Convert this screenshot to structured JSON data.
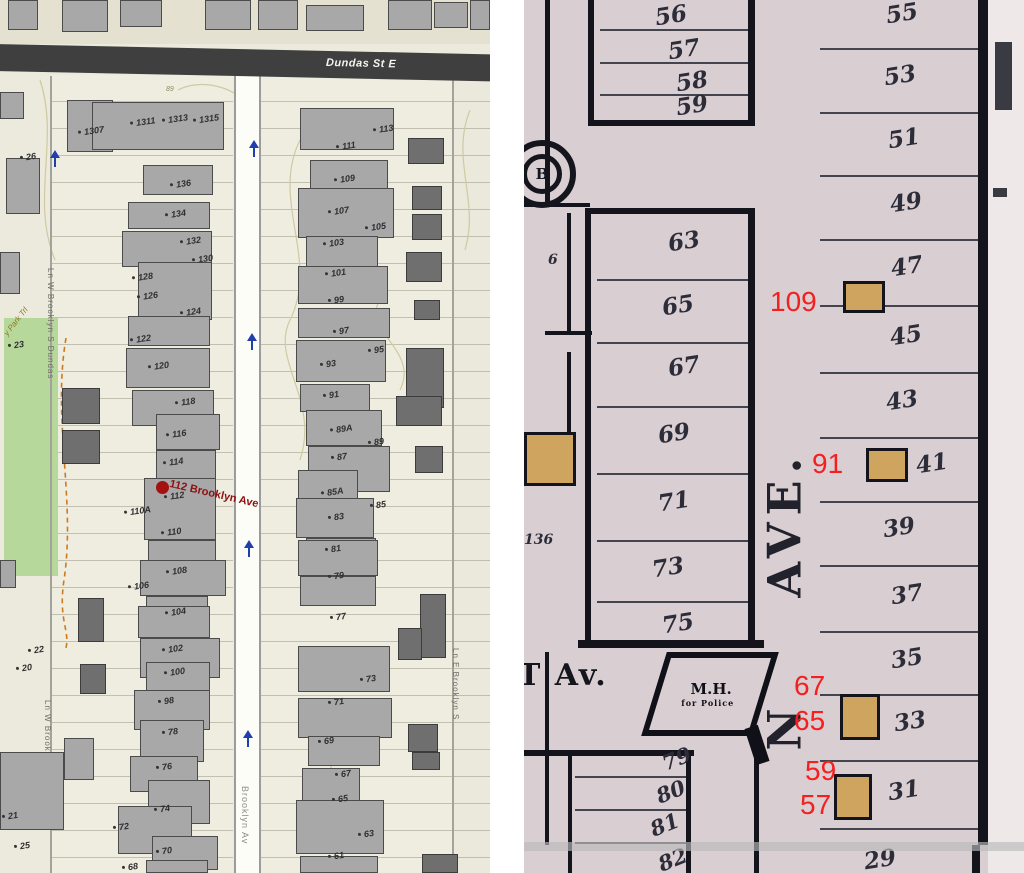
{
  "colors": {
    "red_annotation": "#f42020",
    "selected_red": "#8c1111",
    "park_green": "#b7d89b",
    "road_band_dark": "#3f3f3f",
    "building_gray": "#a8a8a8",
    "building_dark": "#6f6f6f",
    "atlas_tan": "#cfa45f",
    "atlas_pink": "#d9ced2",
    "arrow_blue": "#1f3fae"
  },
  "left_map": {
    "streets": {
      "dundas": "Dundas St E",
      "brooklyn_road": "Brooklyn Av",
      "lane_w1": "Ln W Brooklyn S Dundas",
      "lane_w2": "Ln W Brooklyn S Dundas",
      "lane_e": "Ln E Brooklyn S",
      "park_trail": "y Park Trl"
    },
    "selected": {
      "label": "112 Brooklyn Ave"
    },
    "contour_label": "89",
    "house_labels": [
      {
        "t": "1307",
        "x": 78,
        "y": 126
      },
      {
        "t": "1311",
        "x": 130,
        "y": 117
      },
      {
        "t": "1313",
        "x": 162,
        "y": 114
      },
      {
        "t": "1315",
        "x": 193,
        "y": 114
      },
      {
        "t": "136",
        "x": 170,
        "y": 179
      },
      {
        "t": "134",
        "x": 165,
        "y": 209
      },
      {
        "t": "132",
        "x": 180,
        "y": 236
      },
      {
        "t": "130",
        "x": 192,
        "y": 254
      },
      {
        "t": "128",
        "x": 132,
        "y": 272
      },
      {
        "t": "126",
        "x": 137,
        "y": 291
      },
      {
        "t": "124",
        "x": 180,
        "y": 307
      },
      {
        "t": "122",
        "x": 130,
        "y": 334
      },
      {
        "t": "120",
        "x": 148,
        "y": 361
      },
      {
        "t": "118",
        "x": 175,
        "y": 397
      },
      {
        "t": "116",
        "x": 166,
        "y": 429
      },
      {
        "t": "114",
        "x": 163,
        "y": 457
      },
      {
        "t": "112",
        "x": 164,
        "y": 491
      },
      {
        "t": "110A",
        "x": 124,
        "y": 506
      },
      {
        "t": "110",
        "x": 161,
        "y": 527
      },
      {
        "t": "108",
        "x": 166,
        "y": 566
      },
      {
        "t": "106",
        "x": 128,
        "y": 581
      },
      {
        "t": "104",
        "x": 165,
        "y": 607
      },
      {
        "t": "102",
        "x": 162,
        "y": 644
      },
      {
        "t": "100",
        "x": 164,
        "y": 667
      },
      {
        "t": "98",
        "x": 158,
        "y": 696
      },
      {
        "t": "78",
        "x": 162,
        "y": 727
      },
      {
        "t": "76",
        "x": 156,
        "y": 762
      },
      {
        "t": "74",
        "x": 154,
        "y": 804
      },
      {
        "t": "72",
        "x": 113,
        "y": 822
      },
      {
        "t": "70",
        "x": 156,
        "y": 846
      },
      {
        "t": "68",
        "x": 122,
        "y": 862
      },
      {
        "t": "113",
        "x": 373,
        "y": 124
      },
      {
        "t": "111",
        "x": 336,
        "y": 141
      },
      {
        "t": "109",
        "x": 334,
        "y": 174
      },
      {
        "t": "107",
        "x": 328,
        "y": 206
      },
      {
        "t": "105",
        "x": 365,
        "y": 222
      },
      {
        "t": "103",
        "x": 323,
        "y": 238
      },
      {
        "t": "101",
        "x": 325,
        "y": 268
      },
      {
        "t": "99",
        "x": 328,
        "y": 295
      },
      {
        "t": "97",
        "x": 333,
        "y": 326
      },
      {
        "t": "95",
        "x": 368,
        "y": 345
      },
      {
        "t": "93",
        "x": 320,
        "y": 359
      },
      {
        "t": "91",
        "x": 323,
        "y": 390
      },
      {
        "t": "89A",
        "x": 330,
        "y": 424
      },
      {
        "t": "89",
        "x": 368,
        "y": 437
      },
      {
        "t": "87",
        "x": 331,
        "y": 452
      },
      {
        "t": "85A",
        "x": 321,
        "y": 487
      },
      {
        "t": "85",
        "x": 370,
        "y": 500
      },
      {
        "t": "83",
        "x": 328,
        "y": 512
      },
      {
        "t": "81",
        "x": 325,
        "y": 544
      },
      {
        "t": "79",
        "x": 328,
        "y": 571
      },
      {
        "t": "77",
        "x": 330,
        "y": 612
      },
      {
        "t": "73",
        "x": 360,
        "y": 674
      },
      {
        "t": "71",
        "x": 328,
        "y": 697
      },
      {
        "t": "69",
        "x": 318,
        "y": 736
      },
      {
        "t": "67",
        "x": 335,
        "y": 769
      },
      {
        "t": "65",
        "x": 332,
        "y": 794
      },
      {
        "t": "63",
        "x": 358,
        "y": 829
      },
      {
        "t": "61",
        "x": 328,
        "y": 851
      },
      {
        "t": "26",
        "x": 20,
        "y": 152
      },
      {
        "t": "23",
        "x": 8,
        "y": 340
      },
      {
        "t": "22",
        "x": 28,
        "y": 645
      },
      {
        "t": "20",
        "x": 16,
        "y": 663
      },
      {
        "t": "21",
        "x": 2,
        "y": 811
      },
      {
        "t": "25",
        "x": 14,
        "y": 841
      }
    ],
    "buildings": [
      [
        8,
        0,
        30,
        30,
        "g"
      ],
      [
        62,
        0,
        46,
        32,
        "g"
      ],
      [
        120,
        0,
        42,
        27,
        "g"
      ],
      [
        205,
        0,
        46,
        30,
        "g"
      ],
      [
        258,
        0,
        40,
        30,
        "g"
      ],
      [
        306,
        5,
        58,
        26,
        "g"
      ],
      [
        388,
        0,
        44,
        30,
        "g"
      ],
      [
        434,
        2,
        34,
        26,
        "g"
      ],
      [
        470,
        0,
        20,
        30,
        "g"
      ],
      [
        67,
        100,
        46,
        52,
        "g"
      ],
      [
        92,
        102,
        132,
        48,
        "g"
      ],
      [
        143,
        165,
        70,
        30,
        "g"
      ],
      [
        128,
        202,
        82,
        27,
        "g"
      ],
      [
        122,
        231,
        90,
        36,
        "g"
      ],
      [
        138,
        262,
        74,
        58,
        "g"
      ],
      [
        128,
        316,
        82,
        30,
        "g"
      ],
      [
        126,
        348,
        84,
        40,
        "g"
      ],
      [
        132,
        390,
        82,
        36,
        "g"
      ],
      [
        156,
        414,
        64,
        36,
        "g"
      ],
      [
        156,
        450,
        60,
        32,
        "g"
      ],
      [
        144,
        478,
        72,
        62,
        "g"
      ],
      [
        148,
        540,
        68,
        26,
        "g"
      ],
      [
        140,
        560,
        86,
        36,
        "g"
      ],
      [
        146,
        596,
        62,
        28,
        "g"
      ],
      [
        138,
        606,
        72,
        32,
        "g"
      ],
      [
        140,
        638,
        80,
        40,
        "g"
      ],
      [
        146,
        662,
        64,
        30,
        "g"
      ],
      [
        134,
        690,
        76,
        40,
        "g"
      ],
      [
        140,
        720,
        64,
        42,
        "g"
      ],
      [
        130,
        756,
        68,
        36,
        "g"
      ],
      [
        148,
        780,
        62,
        44,
        "g"
      ],
      [
        118,
        806,
        74,
        48,
        "g"
      ],
      [
        152,
        836,
        66,
        34,
        "g"
      ],
      [
        146,
        860,
        62,
        13,
        "g"
      ],
      [
        300,
        108,
        94,
        42,
        "g"
      ],
      [
        310,
        160,
        78,
        30,
        "g"
      ],
      [
        298,
        188,
        96,
        50,
        "g"
      ],
      [
        306,
        236,
        72,
        32,
        "g"
      ],
      [
        298,
        266,
        90,
        38,
        "g"
      ],
      [
        298,
        308,
        92,
        30,
        "g"
      ],
      [
        296,
        340,
        90,
        42,
        "g"
      ],
      [
        300,
        384,
        70,
        28,
        "g"
      ],
      [
        306,
        410,
        76,
        36,
        "g"
      ],
      [
        308,
        446,
        82,
        46,
        "g"
      ],
      [
        298,
        470,
        60,
        30,
        "g"
      ],
      [
        296,
        498,
        78,
        40,
        "g"
      ],
      [
        306,
        538,
        70,
        32,
        "g"
      ],
      [
        298,
        540,
        80,
        36,
        "g"
      ],
      [
        300,
        576,
        76,
        30,
        "g"
      ],
      [
        298,
        646,
        92,
        46,
        "g"
      ],
      [
        298,
        698,
        94,
        40,
        "g"
      ],
      [
        308,
        736,
        72,
        30,
        "g"
      ],
      [
        302,
        768,
        58,
        36,
        "g"
      ],
      [
        296,
        800,
        88,
        54,
        "g"
      ],
      [
        300,
        856,
        78,
        17,
        "g"
      ],
      [
        6,
        158,
        34,
        56,
        "g"
      ],
      [
        0,
        92,
        24,
        27,
        "g"
      ],
      [
        0,
        252,
        20,
        42,
        "g"
      ],
      [
        0,
        560,
        16,
        28,
        "g"
      ],
      [
        0,
        752,
        64,
        78,
        "g"
      ],
      [
        64,
        738,
        30,
        42,
        "g"
      ],
      [
        62,
        388,
        38,
        36,
        "d"
      ],
      [
        62,
        430,
        38,
        34,
        "d"
      ],
      [
        78,
        598,
        26,
        44,
        "d"
      ],
      [
        80,
        664,
        26,
        30,
        "d"
      ],
      [
        408,
        138,
        36,
        26,
        "d"
      ],
      [
        412,
        186,
        30,
        24,
        "d"
      ],
      [
        412,
        214,
        30,
        26,
        "d"
      ],
      [
        406,
        252,
        36,
        30,
        "d"
      ],
      [
        414,
        300,
        26,
        20,
        "d"
      ],
      [
        406,
        348,
        38,
        60,
        "d"
      ],
      [
        396,
        396,
        46,
        30,
        "d"
      ],
      [
        415,
        446,
        28,
        27,
        "d"
      ],
      [
        420,
        594,
        26,
        64,
        "d"
      ],
      [
        398,
        628,
        24,
        32,
        "d"
      ],
      [
        408,
        724,
        30,
        28,
        "d"
      ],
      [
        412,
        752,
        28,
        18,
        "d"
      ],
      [
        422,
        854,
        36,
        19,
        "d"
      ]
    ],
    "arrows": [
      [
        249,
        140
      ],
      [
        247,
        333
      ],
      [
        244,
        540
      ],
      [
        243,
        730
      ],
      [
        50,
        150
      ]
    ]
  },
  "right_map": {
    "street_vertical_word": "AVE.",
    "street_vertical_fragment": "N",
    "cross_street": "T Av.",
    "corner_building": {
      "line1": "M.H.",
      "line2": "for Police"
    },
    "circle_letter": "B",
    "edge_labels": [
      {
        "t": "6",
        "x": 24,
        "y": 252
      },
      {
        "t": "136",
        "x": 0,
        "y": 532
      }
    ],
    "lots_left_top": [
      {
        "t": "56",
        "x": 131,
        "y": 2
      },
      {
        "t": "57",
        "x": 144,
        "y": 36
      },
      {
        "t": "58",
        "x": 152,
        "y": 68
      },
      {
        "t": "59",
        "x": 152,
        "y": 92
      }
    ],
    "lots_left": [
      {
        "t": "63",
        "x": 144,
        "y": 228
      },
      {
        "t": "65",
        "x": 138,
        "y": 292
      },
      {
        "t": "67",
        "x": 144,
        "y": 353
      },
      {
        "t": "69",
        "x": 134,
        "y": 420
      },
      {
        "t": "71",
        "x": 134,
        "y": 488
      },
      {
        "t": "73",
        "x": 128,
        "y": 554
      },
      {
        "t": "75",
        "x": 138,
        "y": 610
      }
    ],
    "lots_bottom": [
      {
        "t": "79",
        "x": 138,
        "y": 746
      },
      {
        "t": "80",
        "x": 132,
        "y": 779
      },
      {
        "t": "81",
        "x": 126,
        "y": 812
      },
      {
        "t": "82",
        "x": 134,
        "y": 847
      }
    ],
    "lots_right": [
      {
        "t": "55",
        "x": 362,
        "y": 0
      },
      {
        "t": "53",
        "x": 360,
        "y": 62
      },
      {
        "t": "51",
        "x": 364,
        "y": 125
      },
      {
        "t": "49",
        "x": 366,
        "y": 189
      },
      {
        "t": "47",
        "x": 367,
        "y": 253
      },
      {
        "t": "45",
        "x": 366,
        "y": 322
      },
      {
        "t": "43",
        "x": 362,
        "y": 387
      },
      {
        "t": "41",
        "x": 392,
        "y": 450
      },
      {
        "t": "39",
        "x": 359,
        "y": 514
      },
      {
        "t": "37",
        "x": 367,
        "y": 581
      },
      {
        "t": "35",
        "x": 367,
        "y": 645
      },
      {
        "t": "33",
        "x": 370,
        "y": 708
      },
      {
        "t": "31",
        "x": 364,
        "y": 777
      },
      {
        "t": "29",
        "x": 340,
        "y": 846
      }
    ],
    "red_annotations": [
      {
        "t": "109",
        "x": 246,
        "y": 286
      },
      {
        "t": "91",
        "x": 288,
        "y": 448
      },
      {
        "t": "67",
        "x": 270,
        "y": 670
      },
      {
        "t": "65",
        "x": 270,
        "y": 705
      },
      {
        "t": "59",
        "x": 281,
        "y": 755
      },
      {
        "t": "57",
        "x": 276,
        "y": 789
      }
    ],
    "tan_icons": [
      [
        319,
        281,
        42,
        32
      ],
      [
        342,
        448,
        42,
        34
      ],
      [
        316,
        694,
        40,
        46
      ],
      [
        310,
        774,
        38,
        46
      ],
      [
        0,
        432,
        52,
        54
      ]
    ],
    "thin_lines": [
      [
        76,
        29,
        150,
        2
      ],
      [
        76,
        62,
        150,
        2
      ],
      [
        76,
        94,
        150,
        2
      ],
      [
        73,
        279,
        151,
        2
      ],
      [
        73,
        342,
        151,
        2
      ],
      [
        73,
        406,
        151,
        2
      ],
      [
        73,
        473,
        151,
        2
      ],
      [
        73,
        540,
        151,
        2
      ],
      [
        73,
        601,
        151,
        2
      ],
      [
        296,
        48,
        158,
        2
      ],
      [
        296,
        112,
        158,
        2
      ],
      [
        296,
        175,
        158,
        2
      ],
      [
        296,
        239,
        158,
        2
      ],
      [
        296,
        305,
        158,
        2
      ],
      [
        296,
        372,
        158,
        2
      ],
      [
        296,
        437,
        158,
        2
      ],
      [
        296,
        501,
        158,
        2
      ],
      [
        296,
        565,
        158,
        2
      ],
      [
        296,
        631,
        158,
        2
      ],
      [
        296,
        694,
        158,
        2
      ],
      [
        296,
        760,
        158,
        2
      ],
      [
        296,
        828,
        158,
        2
      ],
      [
        51,
        776,
        111,
        2
      ],
      [
        51,
        809,
        111,
        2
      ],
      [
        51,
        842,
        111,
        2
      ]
    ],
    "thick_lines": [
      [
        64,
        0,
        6,
        126
      ],
      [
        224,
        0,
        7,
        126
      ],
      [
        64,
        120,
        167,
        6
      ],
      [
        61,
        208,
        170,
        6
      ],
      [
        61,
        208,
        6,
        440
      ],
      [
        224,
        208,
        7,
        436
      ],
      [
        54,
        640,
        186,
        8
      ],
      [
        21,
        0,
        5,
        206
      ],
      [
        0,
        203,
        66,
        4
      ],
      [
        43,
        213,
        4,
        122
      ],
      [
        21,
        331,
        47,
        4
      ],
      [
        43,
        352,
        4,
        80
      ],
      [
        21,
        652,
        4,
        193
      ],
      [
        44,
        755,
        4,
        118
      ],
      [
        162,
        755,
        5,
        118
      ],
      [
        0,
        750,
        170,
        6
      ],
      [
        230,
        745,
        5,
        128
      ],
      [
        454,
        0,
        10,
        845
      ],
      [
        448,
        845,
        8,
        28
      ]
    ],
    "margin_fragments": [
      [
        471,
        42,
        17,
        68
      ],
      [
        469,
        188,
        14,
        9
      ]
    ]
  }
}
